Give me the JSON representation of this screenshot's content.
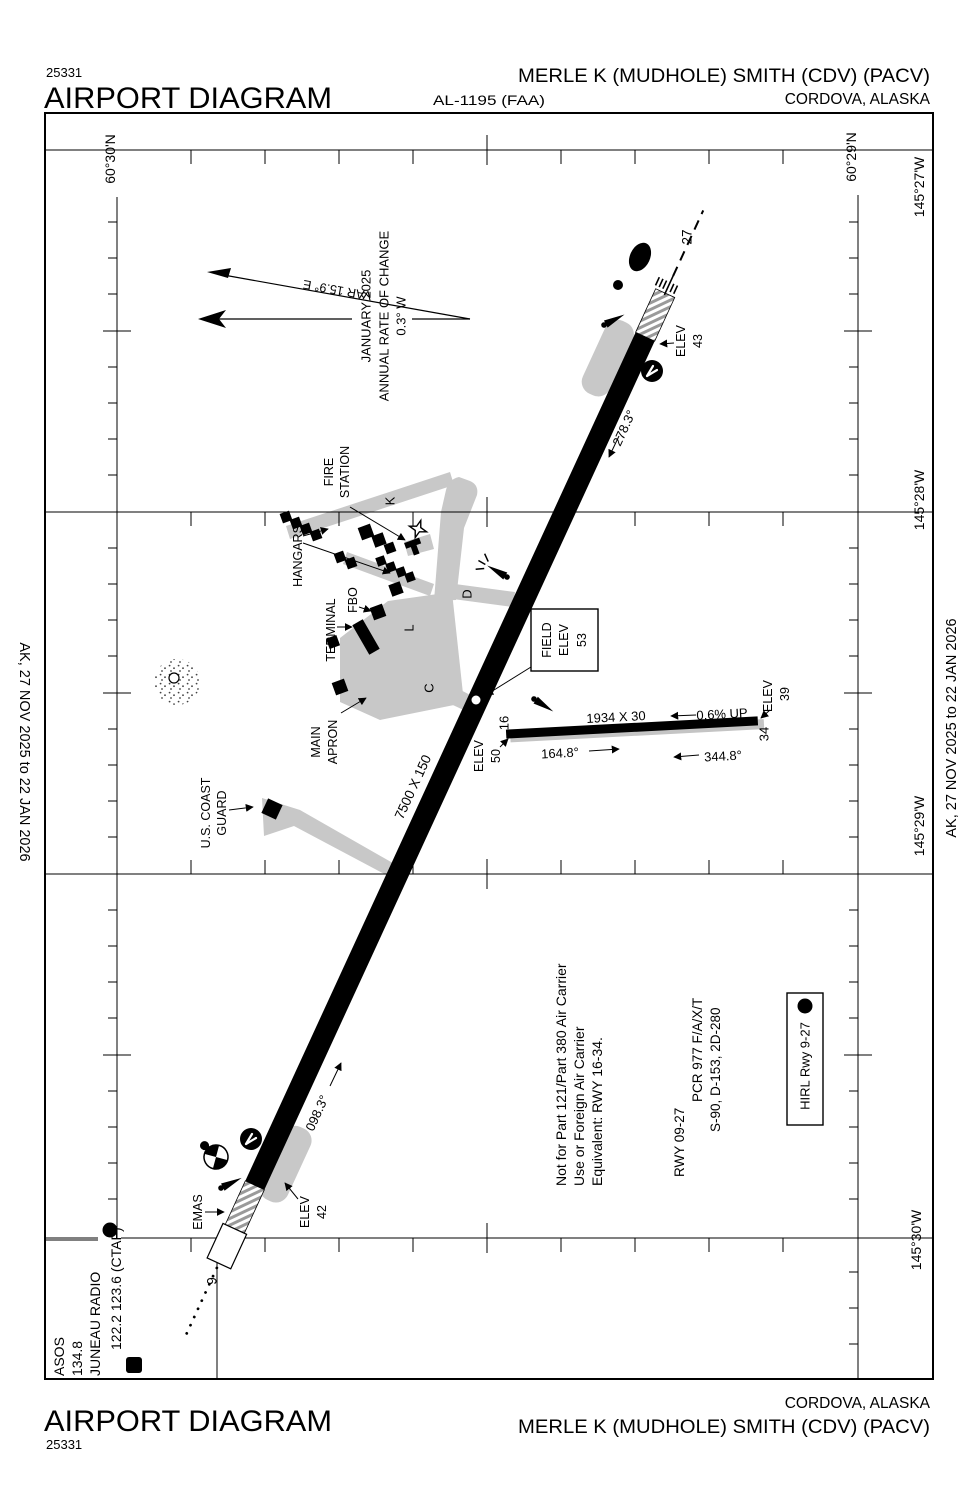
{
  "doc": {
    "chart_id": "25331",
    "title": "AIRPORT DIAGRAM",
    "al": "AL-1195 (FAA)",
    "airport": "MERLE K (MUDHOLE) SMITH (CDV) (PACV)",
    "city": "CORDOVA, ALASKA",
    "effective": "AK,  27 NOV 2025  to  22 JAN 2026"
  },
  "coords": {
    "lat_left": "60°30'N",
    "lat_right": "60°29'N",
    "lon1": "145°27'W",
    "lon2": "145°28'W",
    "lon3": "145°29'W",
    "lon4": "145°30'W"
  },
  "compass": {
    "var": "VAR 15.9° E",
    "line1": "JANUARY 2025",
    "line2": "ANNUAL RATE OF CHANGE",
    "line3": "0.3° W"
  },
  "field_elev": {
    "line1": "FIELD",
    "line2": "ELEV",
    "value": "53"
  },
  "main_runway": {
    "size": "7500 X 150",
    "hdg9": "098.3°",
    "hdg27": "278.3°",
    "num9": "9",
    "num27": "27",
    "elev_label": "ELEV",
    "elev9": "42",
    "elev27": "43",
    "emas": "EMAS"
  },
  "crosswind_runway": {
    "size": "1934 X 30",
    "slope": "0.6% UP",
    "hdg16": "164.8°",
    "hdg34": "344.8°",
    "num16": "16",
    "num34": "34",
    "elev16": "50",
    "elev34": "39"
  },
  "facilities": {
    "fire1": "FIRE",
    "fire2": "STATION",
    "hangars": "HANGARS",
    "fbo": "FBO",
    "terminal": "TERMINAL",
    "apron1": "MAIN",
    "apron2": "APRON",
    "uscg1": "U.S. COAST",
    "uscg2": "GUARD"
  },
  "taxiways": {
    "a5": "A5",
    "c": "C",
    "d": "D",
    "k": "K",
    "l": "L"
  },
  "notes": {
    "carrier1": "Not for Part 121/Part 380 Air Carrier",
    "carrier2": "Use or Foreign Air Carrier",
    "carrier3": "Equivalent: RWY 16-34.",
    "pcn1": "RWY 09-27",
    "pcn2": "PCR 977 F/A/X/T",
    "pcn3": "S-90, D-153, 2D-280",
    "hirl": "HIRL Rwy 9-27",
    "light_symbol": "L"
  },
  "comms": {
    "asos": "ASOS",
    "asos_freq": "134.8",
    "station": "JUNEAU RADIO",
    "freqs": "122.2  123.6 (CTAF)",
    "d_symbol": "D",
    "l_symbol": "L"
  }
}
